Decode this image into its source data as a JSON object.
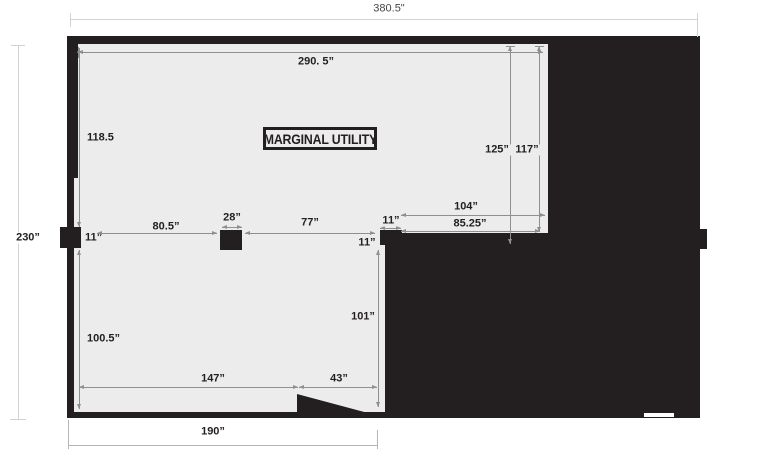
{
  "title_box": {
    "label": "MARGINAL UTILITY"
  },
  "dimensions": {
    "overall_width": "380.5\"",
    "left_height": "230”",
    "top_width": "290. 5”",
    "upper_left_height": "118.5",
    "lower_left_height": "100.5”",
    "left_post_width": "11”",
    "span_left": "80.5”",
    "column_width": "28”",
    "span_mid": "77”",
    "stub_height": "11”",
    "stub_width": "11”",
    "right_width": "104”",
    "right_opening": "85.25”",
    "right_height_outer": "125”",
    "right_height_inner": "117”",
    "lower_right_height": "101”",
    "notch_width": "43”",
    "span_lower": "147”",
    "bottom_width": "190”"
  },
  "colors": {
    "ink": "#231f20",
    "room_fill": "#ececec",
    "dim_line": "#8f8f8f",
    "outer_dim_line": "#d2d2d2",
    "page_bg": "#ffffff"
  }
}
